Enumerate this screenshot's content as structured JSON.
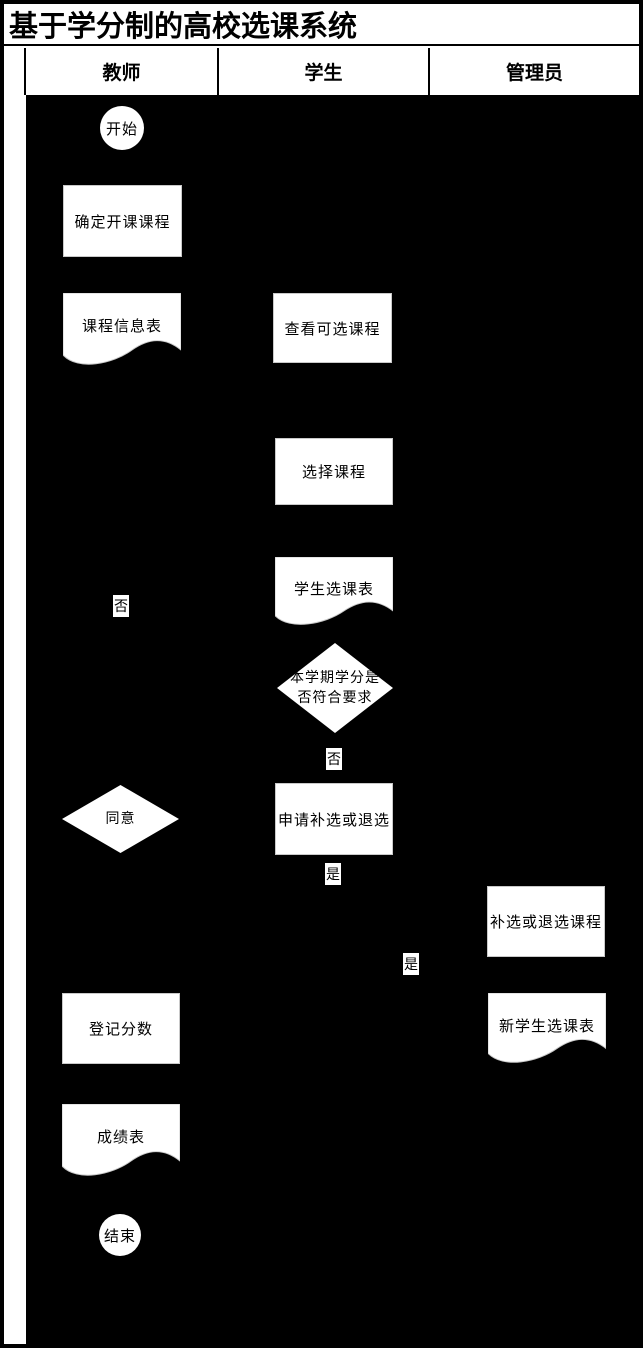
{
  "title": "基于学分制的高校选课系统",
  "lanes": {
    "teacher": "教师",
    "student": "学生",
    "admin": "管理员"
  },
  "nodes": {
    "start": "开始",
    "determine_courses": "确定开课课程",
    "course_info_table": "课程信息表",
    "view_available_courses": "查看可选课程",
    "select_courses": "选择课程",
    "student_course_table": "学生选课表",
    "credit_check": "本学期学分是否符合要求",
    "agree": "同意",
    "apply_add_drop": "申请补选或退选",
    "add_drop_courses": "补选或退选课程",
    "register_scores": "登记分数",
    "new_student_course_table": "新学生选课表",
    "score_table": "成绩表",
    "end": "结束"
  },
  "edge_labels": {
    "teacher_no": "否",
    "credit_no": "否",
    "apply_yes": "是",
    "admin_yes": "是"
  },
  "colors": {
    "canvas_background": "#000000",
    "shape_fill": "#ffffff",
    "text": "#000000"
  }
}
